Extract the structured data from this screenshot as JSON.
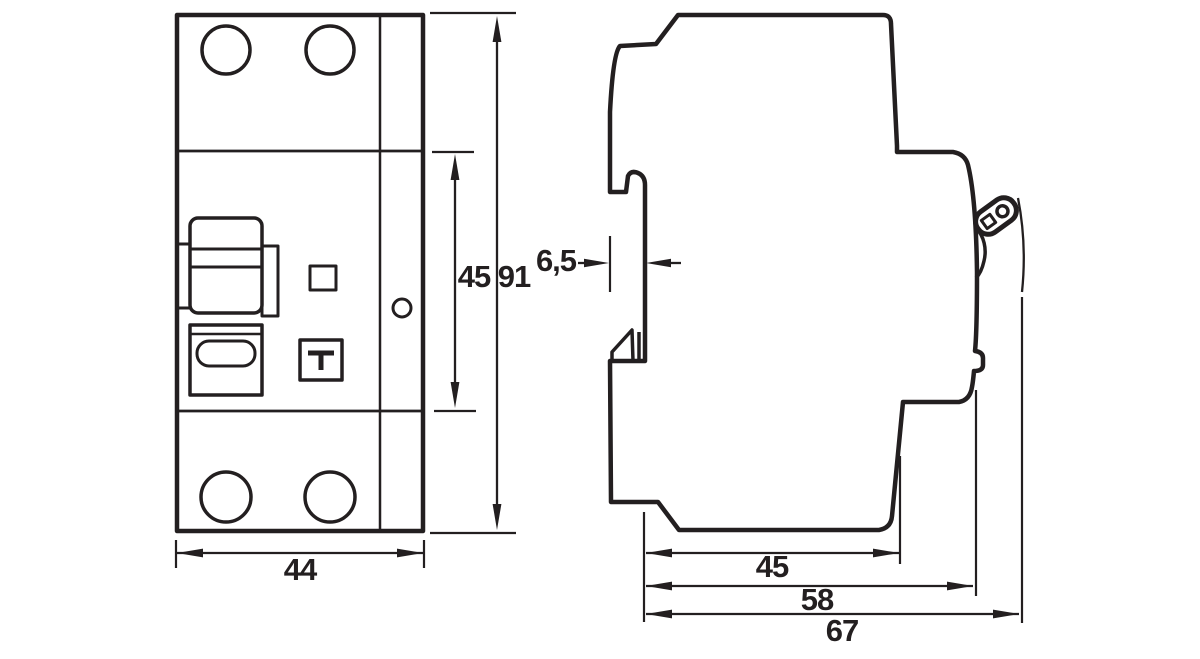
{
  "colors": {
    "line": "#231f20",
    "background": "#ffffff"
  },
  "front_view": {
    "width_mm": "44",
    "upper_body_height_mm": "45",
    "total_height_mm": "91"
  },
  "side_view": {
    "rail_recess_depth_mm": "6,5",
    "base_depth_mm": "45",
    "depth_without_lever_mm": "58",
    "total_depth_mm": "67"
  }
}
